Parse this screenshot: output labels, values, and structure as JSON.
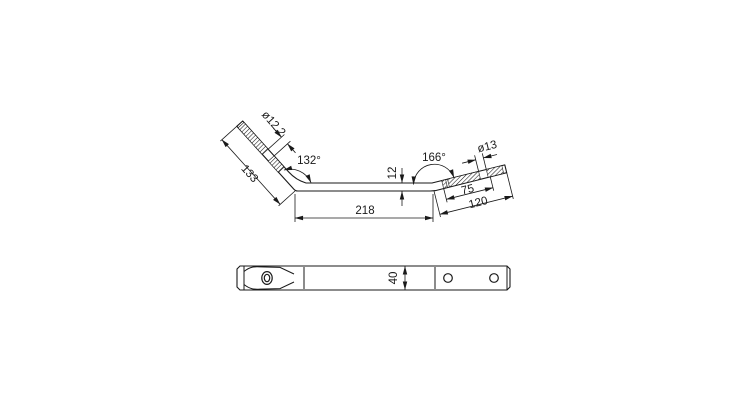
{
  "drawing": {
    "type": "technical-drawing",
    "views": {
      "side_view": "side elevation of bent flat bar",
      "plan_view": "plan view of bar"
    },
    "labels": {
      "dia_left_hole": "ø12.2",
      "left_arm_length": "133",
      "left_bend_angle": "132°",
      "bar_thickness": "12",
      "right_bend_angle": "166°",
      "dia_right_hole": "ø13",
      "right_hole_offset": "75",
      "right_arm_length": "120",
      "middle_length": "218",
      "bar_width": "40"
    },
    "colors": {
      "line": "#1a1a1a",
      "background": "#ffffff"
    }
  }
}
